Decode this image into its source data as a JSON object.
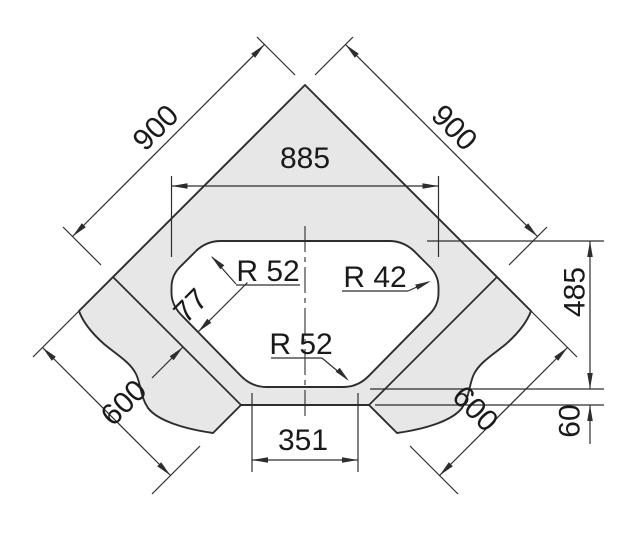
{
  "drawing": {
    "title": "corner-sink-dimension-drawing",
    "view": "plan",
    "colors": {
      "line": "#2d2d2d",
      "fill": "#e7e7e7",
      "background": "#ffffff",
      "text": "#1a1a1a"
    },
    "labels": {
      "d900_left": "900",
      "d900_right": "900",
      "d885": "885",
      "d485": "485",
      "d60": "60",
      "d351": "351",
      "d600_left": "600",
      "d600_right": "600",
      "d77": "77",
      "r_top_left": "R 52",
      "r_right": "R 42",
      "r_bottom": "R 52"
    },
    "values_mm": {
      "corner_side_left": 900,
      "corner_side_right": 900,
      "bowl_width": 885,
      "bowl_depth": 485,
      "bowl_front_width": 351,
      "run_depth_left": 600,
      "run_depth_right": 600,
      "rim_width_side": 77,
      "rim_width_front": 60,
      "radius_top_left": 52,
      "radius_right": 42,
      "radius_bottom": 52
    }
  }
}
